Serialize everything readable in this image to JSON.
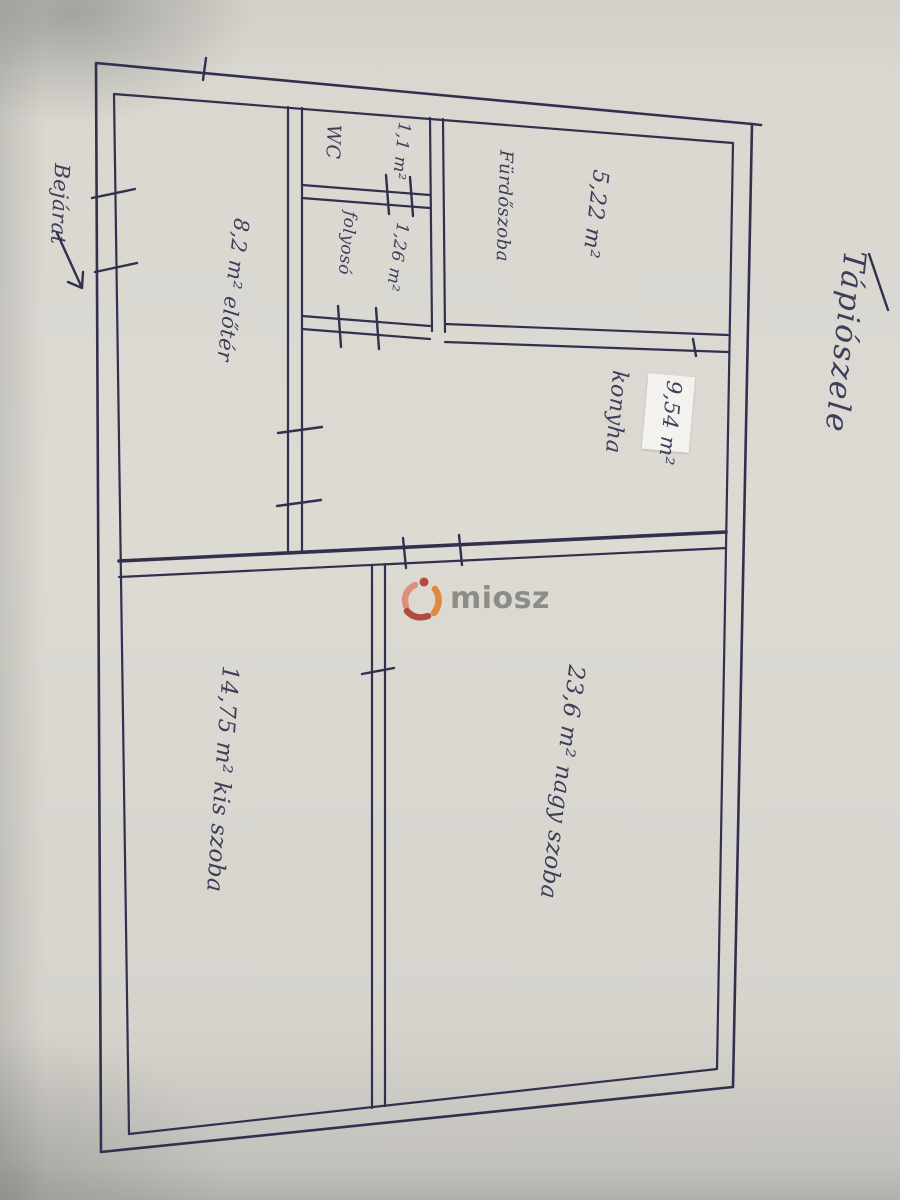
{
  "plan": {
    "location_label": "Tápiószele",
    "entrance_label": "Bejárat",
    "rooms": {
      "eloter": {
        "label": "8,2 m² előtér"
      },
      "wc": {
        "label": "WC",
        "area": "1,1 m²"
      },
      "folyoso": {
        "label": "folyosó",
        "area": "1,26 m²"
      },
      "furdoszoba": {
        "label": "Fürdőszoba",
        "area": "5,22 m²"
      },
      "konyha": {
        "label": "konyha",
        "area": "9,54 m²"
      },
      "kis_szoba": {
        "label": "14,75 m² kis szoba"
      },
      "nagy_szoba": {
        "label": "23,6 m² nagy szoba"
      }
    }
  },
  "watermark": {
    "text": "miosz"
  },
  "colors": {
    "ink": "#32304f",
    "watermark_gray": "#85857f",
    "logo_red": "#b03a2e",
    "logo_salmon": "#dd8878",
    "logo_orange": "#e0802f"
  }
}
